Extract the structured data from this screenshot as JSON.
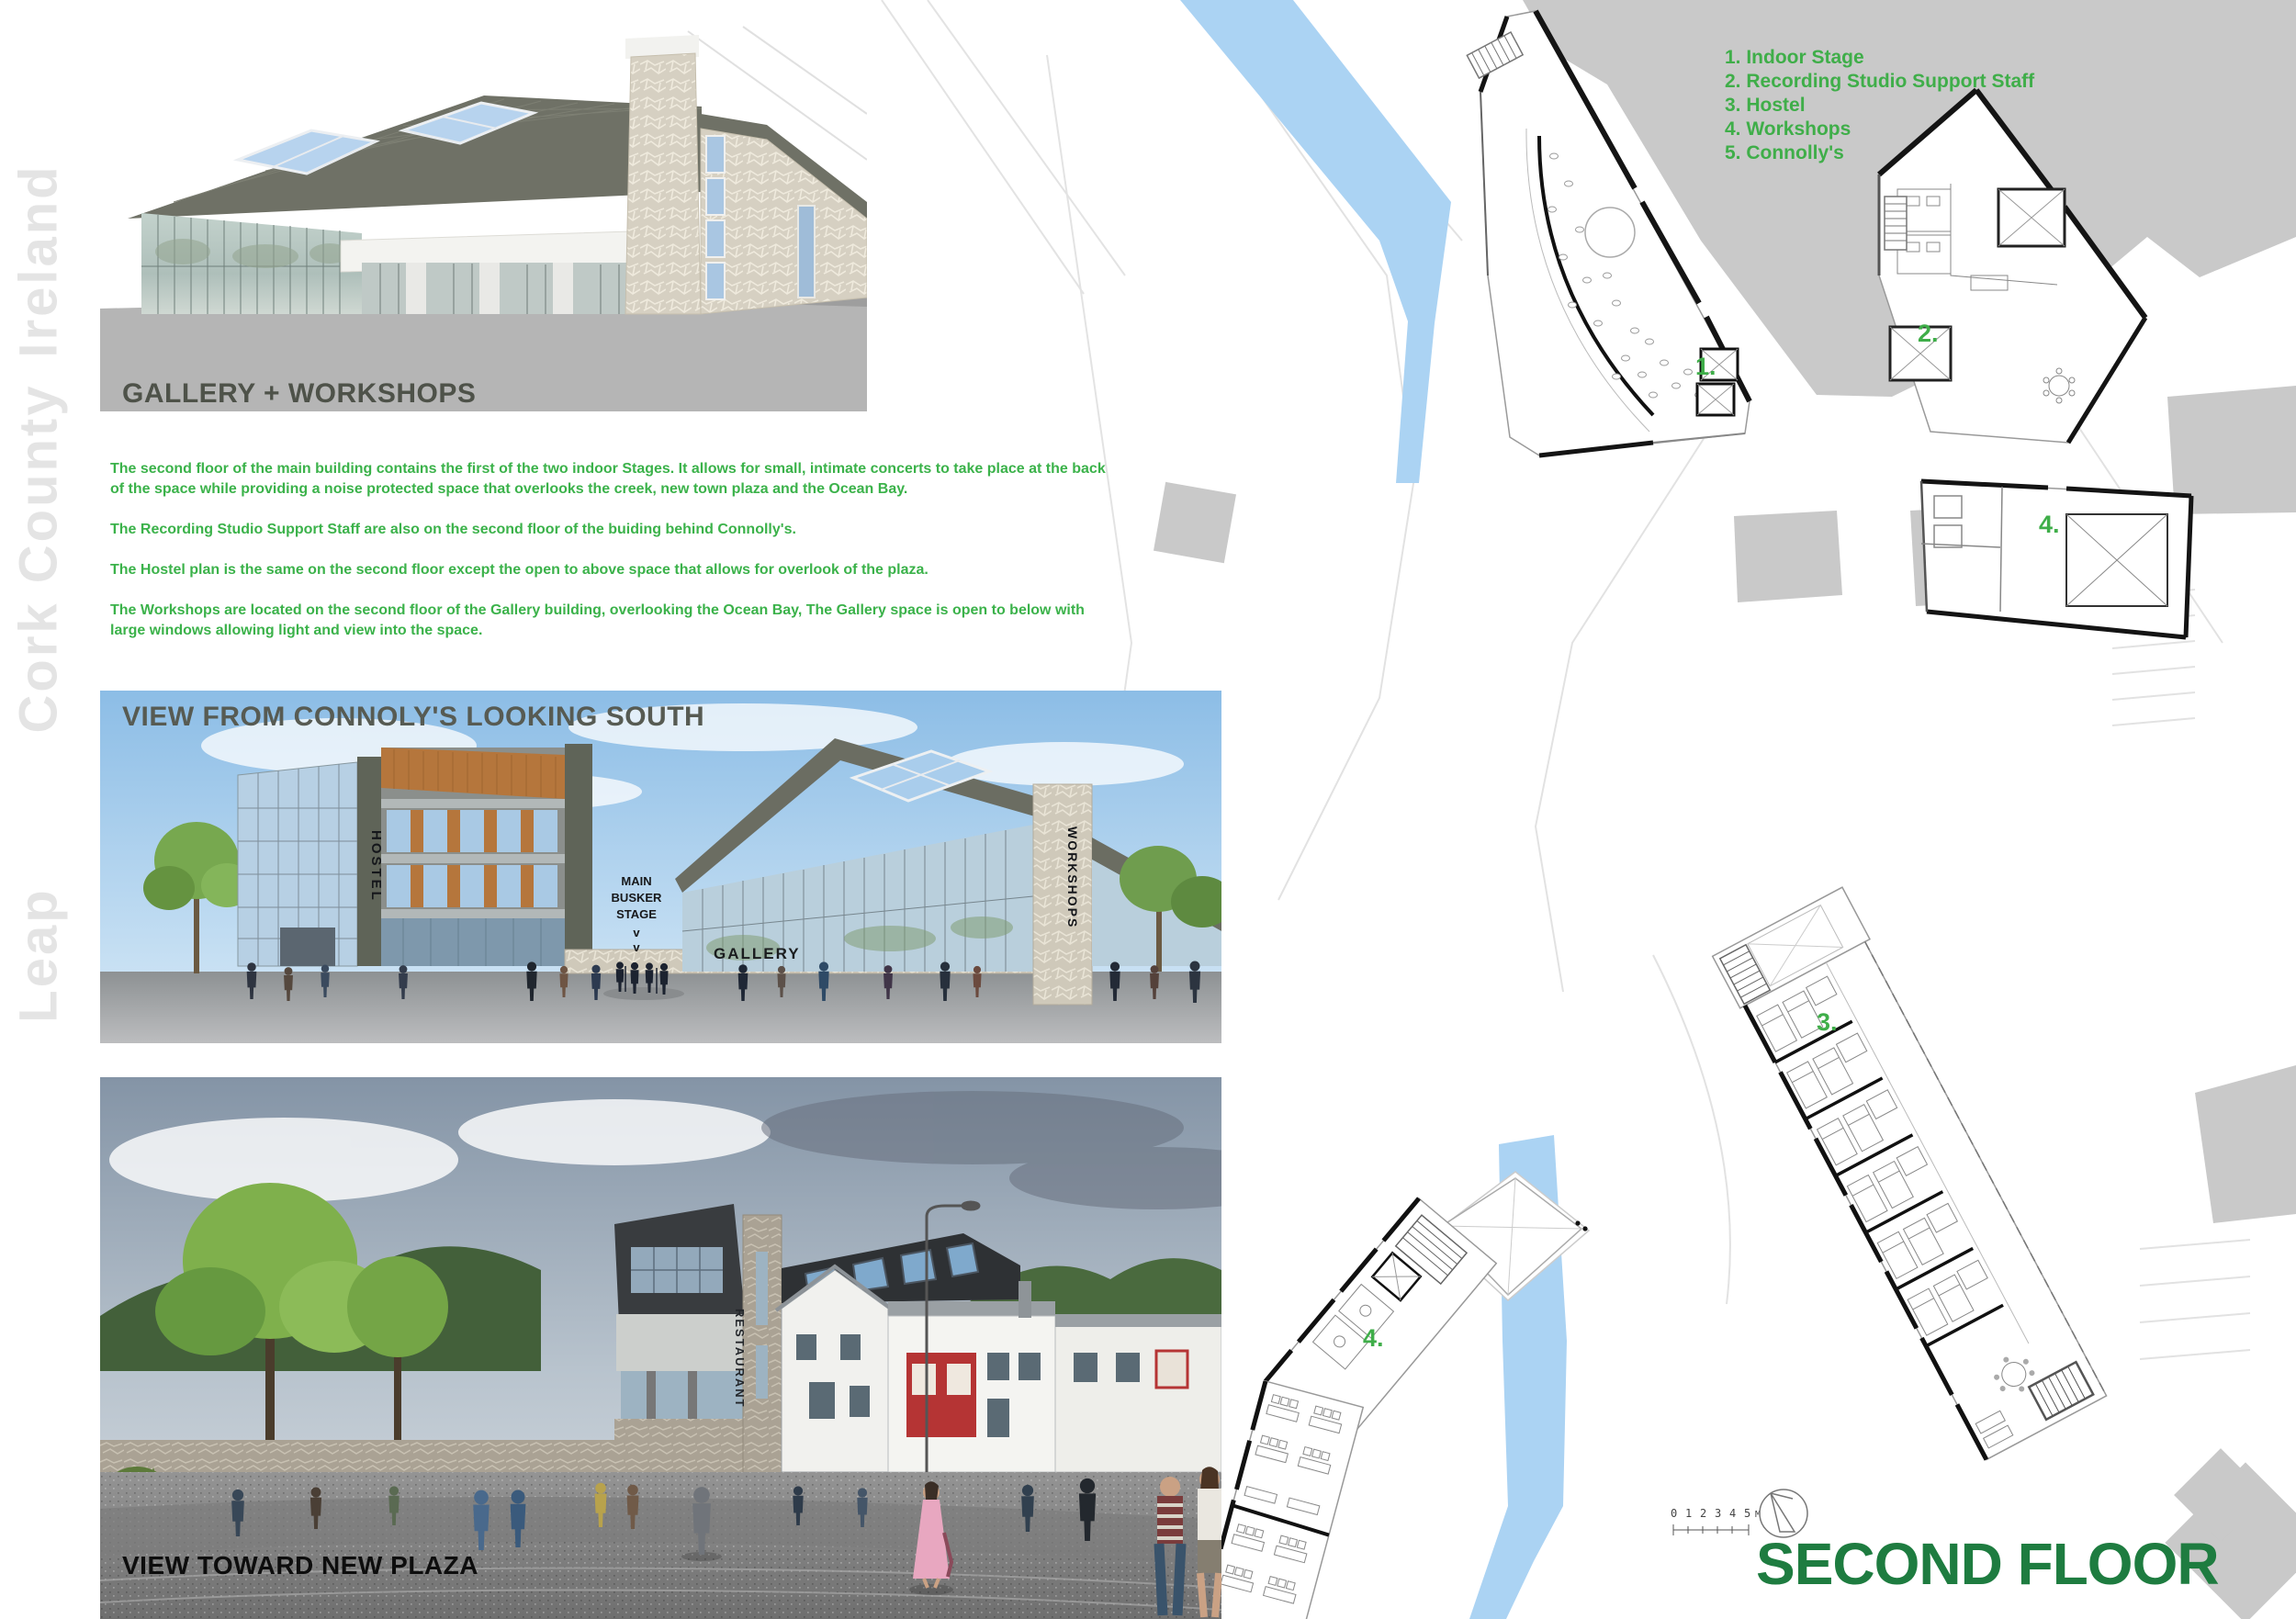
{
  "sidebar": {
    "location_lines": [
      "Leap",
      "Cork County",
      "Ireland"
    ]
  },
  "gallery_panel": {
    "label": "GALLERY + WORKSHOPS"
  },
  "description": {
    "p1": "The second floor of the main building contains the first of the two indoor Stages. It allows for small, intimate concerts to take place at the back of the space while providing a noise protected space that overlooks the creek, new town plaza and the Ocean Bay.",
    "p2": "The Recording Studio Support Staff are also on the second floor of the buiding behind Connolly's.",
    "p3": "The Hostel plan is the same on the second floor except the open to above space that allows for overlook of the plaza.",
    "p4": "The Workshops are located on the second floor of the Gallery building, overlooking the Ocean Bay, The Gallery space is open to below with large windows allowing light and view into the space."
  },
  "connolys_view_panel": {
    "title": "VIEW FROM CONNOLY'S LOOKING SOUTH",
    "labels": {
      "hostel": "HOSTEL",
      "busker_line1": "MAIN",
      "busker_line2": "BUSKER",
      "busker_line3": "STAGE",
      "busker_arrow": "v",
      "gallery": "GALLERY",
      "workshops": "WORKSHOPS"
    }
  },
  "plaza_view_panel": {
    "title": "VIEW TOWARD NEW PLAZA",
    "labels": {
      "restaurant": "RESTAURANT"
    }
  },
  "site_plan": {
    "legend": {
      "items": [
        "1. Indoor Stage",
        "2. Recording Studio Support Staff",
        "3. Hostel",
        "4. Workshops",
        "5. Connolly's"
      ]
    },
    "plan_labels": {
      "stage": "1.",
      "recording": "2.",
      "hostel": "3.",
      "workshops_top": "4.",
      "workshops_bottom": "4."
    },
    "scale_bar": {
      "ticks": [
        "0",
        "1",
        "2",
        "3",
        "4",
        "5"
      ],
      "unit": "M"
    },
    "floor_title": "SECOND FLOOR"
  },
  "colors": {
    "accent_green": "#3BB24A",
    "title_green": "#1E7C40",
    "creek_blue": "#ABD3F3",
    "context_gray": "#C9C9C9"
  }
}
